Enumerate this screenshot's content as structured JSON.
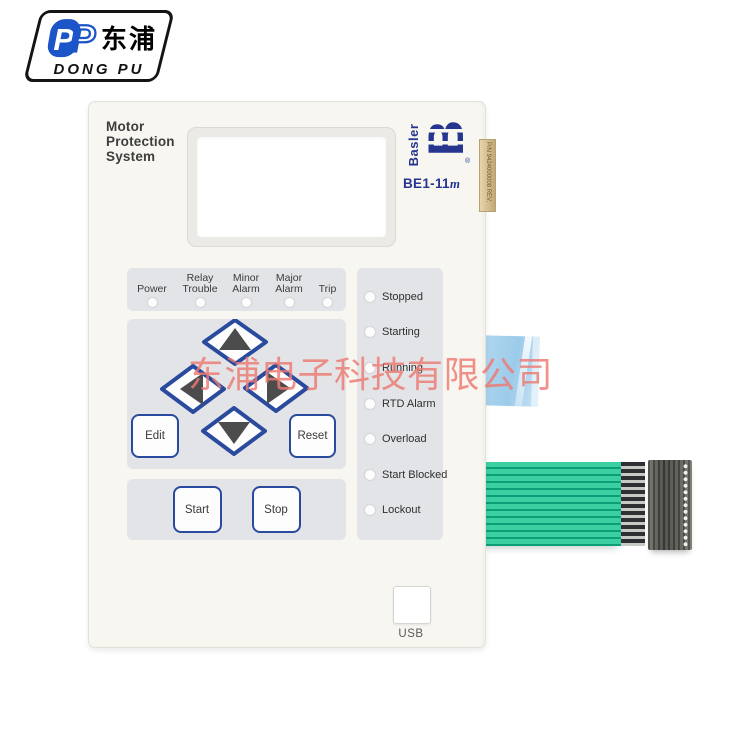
{
  "brand": {
    "logo_cn": "东浦",
    "logo_en": "DONG PU",
    "p_monogram": "P",
    "logo_blue": "#1b55c8"
  },
  "watermark": {
    "text": "东浦电子科技有限公司",
    "color": "#ee7a72"
  },
  "panel": {
    "title_lines": [
      "Motor",
      "Protection",
      "System"
    ],
    "maker": "Basler",
    "maker_mark": "B",
    "registered": "®",
    "model": "BE1-11",
    "model_suffix": "m",
    "side_label": "P/N 9424000008 REV.",
    "accent_blue": "#26368f",
    "button_border_blue": "#2a4a9e",
    "panel_bg": "#f7f6f1",
    "subpanel_bg": "#e2e4e7"
  },
  "indicator_row": {
    "items": [
      {
        "line1": "",
        "line2": "Power"
      },
      {
        "line1": "Relay",
        "line2": "Trouble"
      },
      {
        "line1": "Minor",
        "line2": "Alarm"
      },
      {
        "line1": "Major",
        "line2": "Alarm"
      },
      {
        "line1": "",
        "line2": "Trip"
      }
    ]
  },
  "keypad": {
    "edit_label": "Edit",
    "reset_label": "Reset",
    "arrow_icons": [
      "arrow-up",
      "arrow-left",
      "arrow-right",
      "arrow-down"
    ]
  },
  "motor_controls": {
    "start_label": "Start",
    "stop_label": "Stop"
  },
  "status_column": {
    "items": [
      "Stopped",
      "Starting",
      "Running",
      "RTD Alarm",
      "Overload",
      "Start Blocked",
      "Lockout"
    ]
  },
  "usb": {
    "label": "USB"
  },
  "cable": {
    "ribbon_green": "#3bd0a1",
    "ribbon_separator": "#0d9d77",
    "connector_gray": "#55554f",
    "film_blue": "#a8d3ef",
    "sticker_tan": "#d9c08e"
  }
}
